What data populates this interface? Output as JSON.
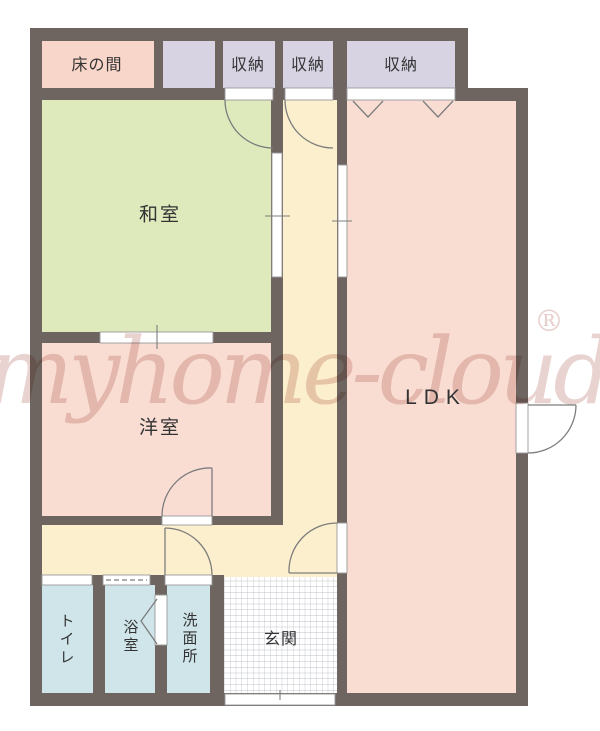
{
  "watermark": {
    "text": "myhome-cloud",
    "registered": "®"
  },
  "rooms": {
    "tokonoma": {
      "label": "床の間"
    },
    "storage_a": {
      "label": "収納"
    },
    "storage_b": {
      "label": "収納"
    },
    "storage_c": {
      "label": "収納"
    },
    "washitsu": {
      "label": "和室"
    },
    "yoshitsu": {
      "label": "洋室"
    },
    "ldk": {
      "label": "LDK"
    },
    "toilet": {
      "label": "トイレ"
    },
    "bath": {
      "label": "浴室"
    },
    "washroom": {
      "label": "洗面所"
    },
    "genkan": {
      "label": "玄関"
    }
  },
  "colors": {
    "wall": "#6e6560",
    "washitsu": "#dee9bc",
    "corridor": "#fcefcd",
    "pink_room": "#f9ddd3",
    "tokonoma": "#f8d6ca",
    "storage": "#d7d3e3",
    "wet_room": "#cfe5ea",
    "door_line": "#7d7d7d",
    "open_line": "#9a9a9a",
    "grid_line": "#a9adb9",
    "watermark": "#c9958e"
  }
}
